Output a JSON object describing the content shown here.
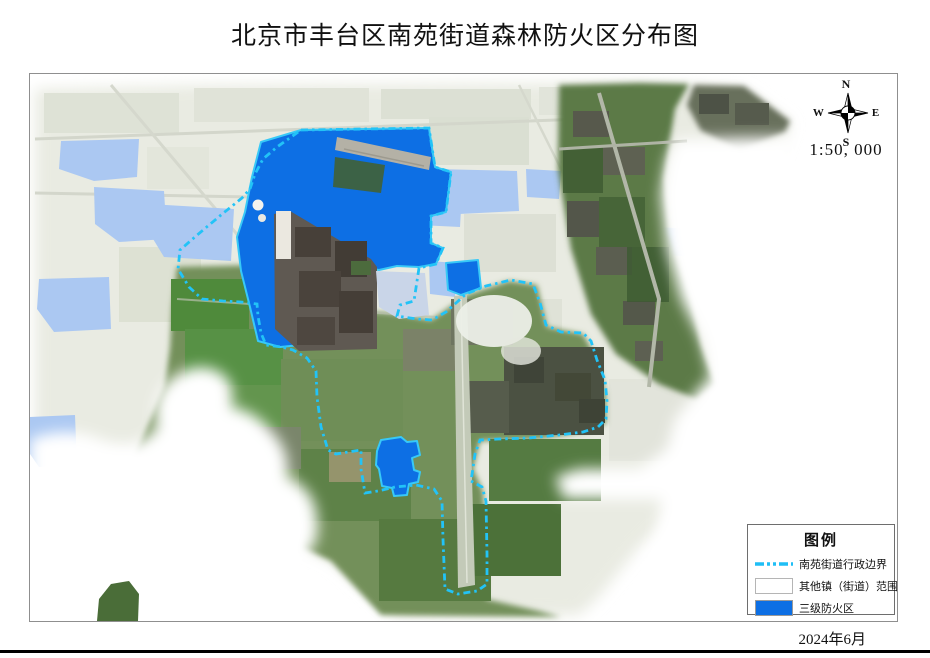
{
  "page": {
    "title": "北京市丰台区南苑街道森林防火区分布图",
    "date": "2024年6月"
  },
  "map": {
    "scale": "1:50, 000",
    "compass": {
      "n": "N",
      "e": "E",
      "s": "S",
      "w": "W"
    },
    "colors": {
      "fire_zone_blue": "#0d6fe4",
      "boundary_cyan": "#22c3f7",
      "other_town_light_blue": "#abc8f2"
    }
  },
  "legend": {
    "title": "图例",
    "items": [
      {
        "label": "南苑街道行政边界",
        "swatch": "dashed-line"
      },
      {
        "label": "其他镇（街道）范围",
        "swatch": "white-box"
      },
      {
        "label": "三级防火区",
        "swatch": "blue-box"
      }
    ]
  }
}
